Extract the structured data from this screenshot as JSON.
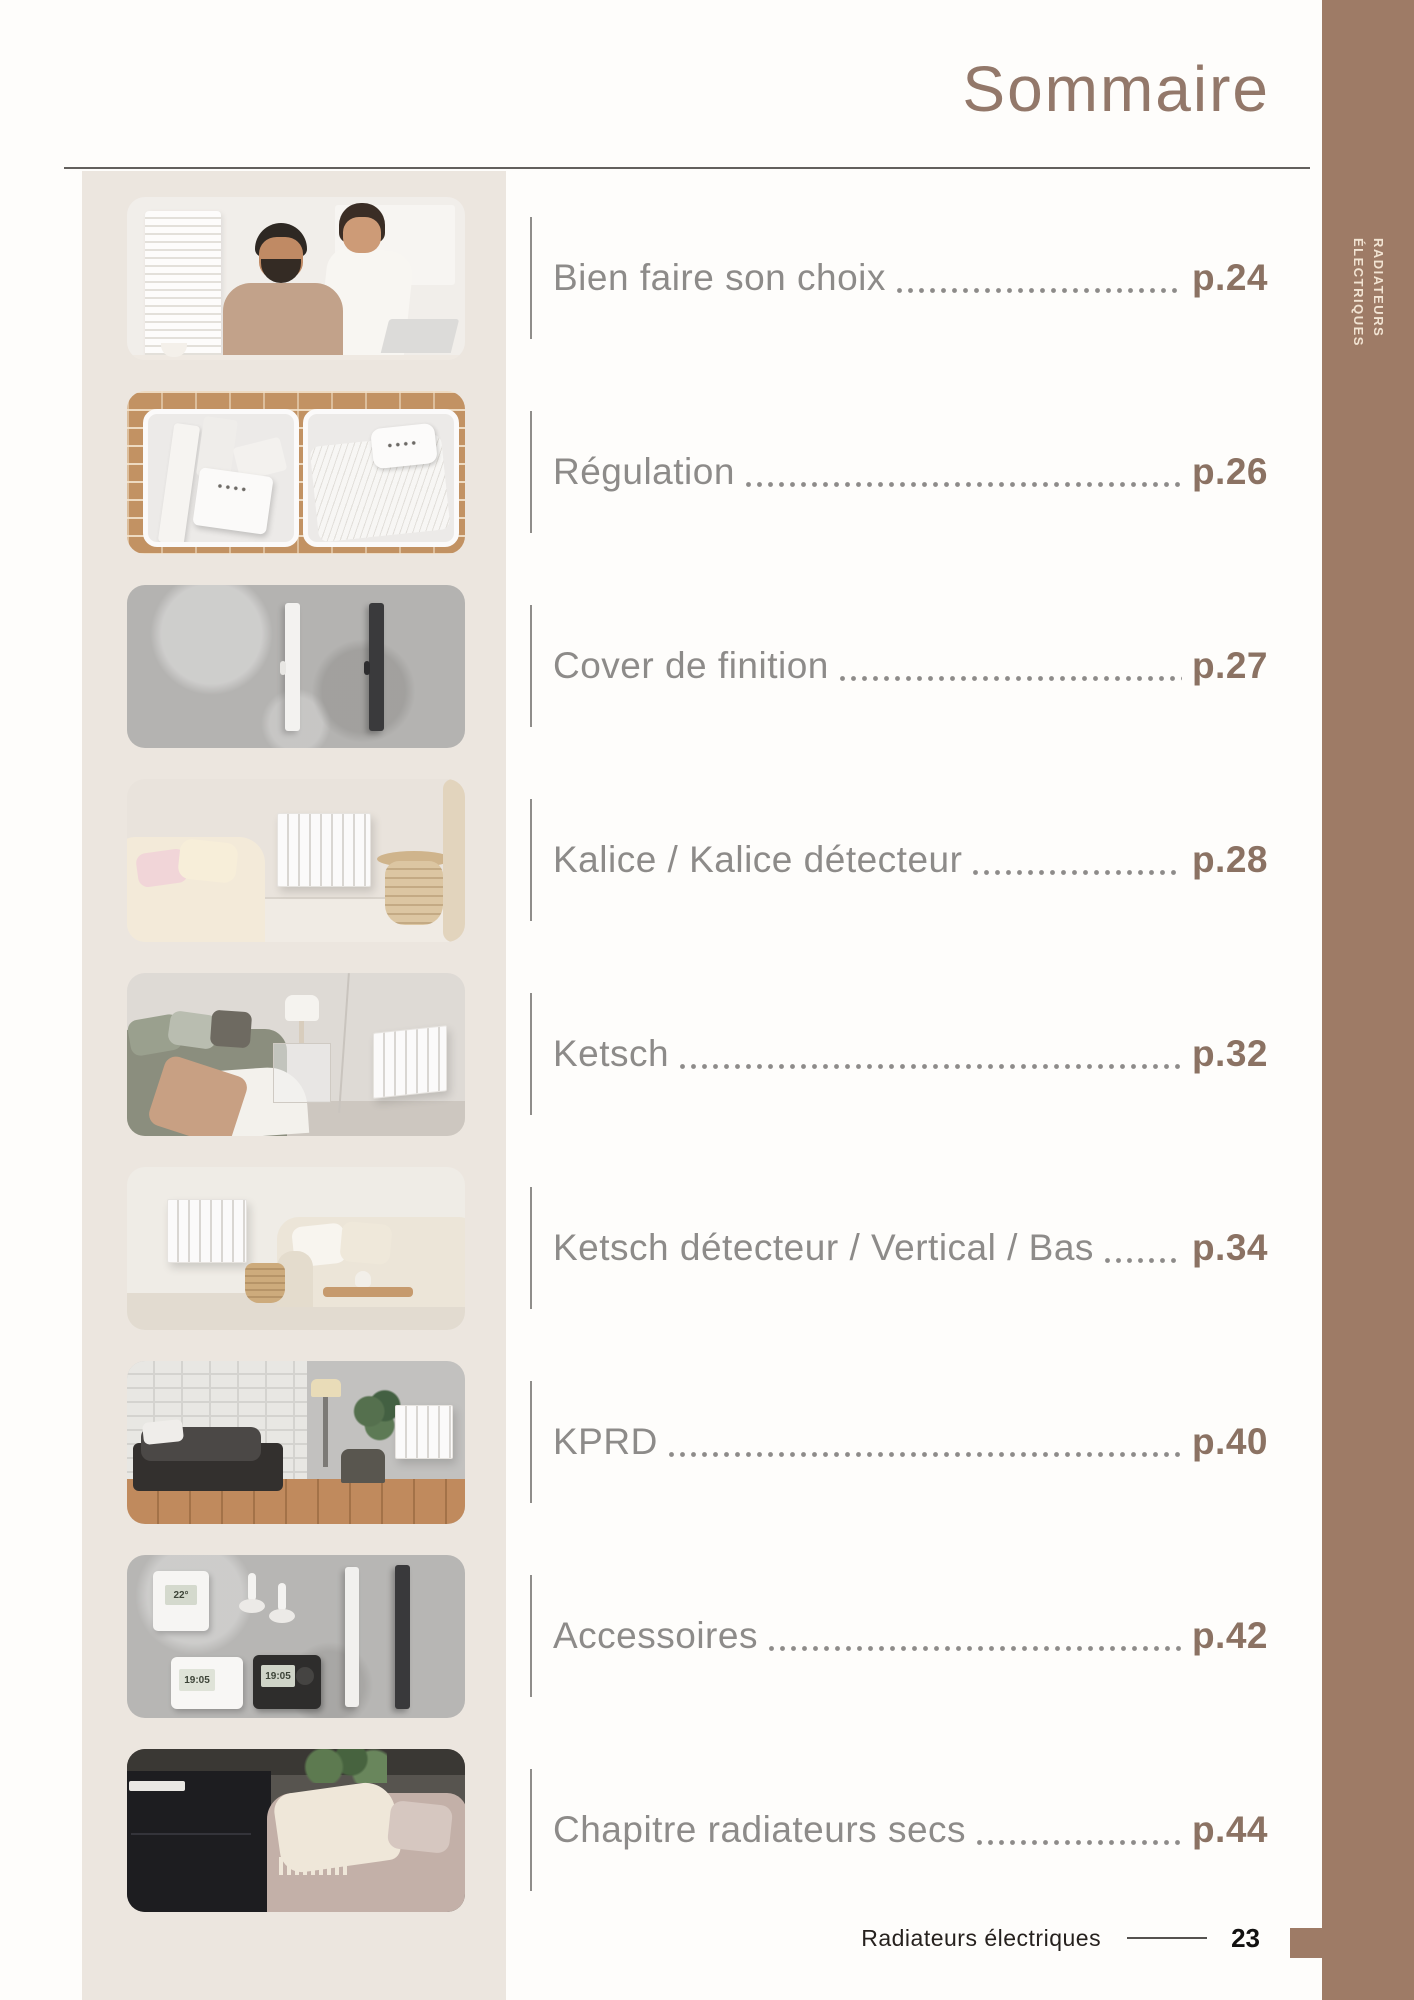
{
  "page": {
    "title": "Sommaire",
    "side_tab": {
      "line1": "RADIATEURS",
      "line2": "ÉLECTRIQUES"
    },
    "footer": {
      "label": "Radiateurs électriques",
      "page_number": "23"
    }
  },
  "toc": {
    "entries": [
      {
        "label": "Bien faire son choix",
        "page": "p.24",
        "thumb": "couple-consulting-laptop"
      },
      {
        "label": "Régulation",
        "page": "p.26",
        "thumb": "radiator-control-panels-on-brick"
      },
      {
        "label": "Cover de finition",
        "page": "p.27",
        "thumb": "white-and-black-cover-bars-on-concrete"
      },
      {
        "label": "Kalice / Kalice détecteur",
        "page": "p.28",
        "thumb": "beige-bedroom-wall-radiator"
      },
      {
        "label": "Ketsch",
        "page": "p.32",
        "thumb": "bedroom-with-radiator-right-wall"
      },
      {
        "label": "Ketsch détecteur / Vertical / Bas",
        "page": "p.34",
        "thumb": "living-room-radiator-and-sofa"
      },
      {
        "label": "KPRD",
        "page": "p.40",
        "thumb": "loft-bedroom-brick-wall-radiator"
      },
      {
        "label": "Accessoires",
        "page": "p.42",
        "thumb": "thermostats-and-accessories-flatlay"
      },
      {
        "label": "Chapitre radiateurs secs",
        "page": "p.44",
        "thumb": "black-cabinet-and-sofa"
      }
    ]
  },
  "accessories_thumb": {
    "wall_thermostat_display": "22°",
    "programmer_white_display": "19:05",
    "programmer_black_display": "19:05"
  },
  "colors": {
    "accent_brown": "#9e7b66",
    "page_number_brown": "#8b7263",
    "entry_text_gray": "#8d8b89",
    "panel_beige": "#ece6df"
  }
}
